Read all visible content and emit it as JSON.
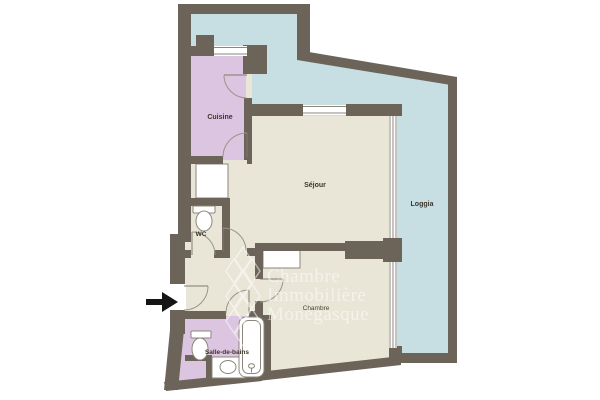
{
  "plan": {
    "rooms": {
      "cuisine": {
        "label": "Cuisine",
        "fill": "#dcc5e0"
      },
      "sejour": {
        "label": "Séjour",
        "fill": "#e9e6d7"
      },
      "loggia": {
        "label": "Loggia",
        "fill": "#c7dee2"
      },
      "wc": {
        "label": "WC",
        "fill": "#e9e6d7"
      },
      "chambre": {
        "label": "Chambre",
        "fill": "#e9e6d7"
      },
      "salle_de_bains": {
        "label": "Salle-de-bains",
        "fill": "#dcc5e0"
      }
    },
    "watermark": {
      "line1": "Chambre",
      "line2": "Immobilière",
      "line3": "Monégasque",
      "color": "#ffffff"
    },
    "colors": {
      "wall": "#6c6359",
      "floor_beige": "#e9e6d7",
      "kitchen_bath_purple": "#dcc5e0",
      "terrace_blue": "#c7dee2",
      "fixture_line": "#8d867b",
      "label_text": "#3a362d",
      "entrance_arrow": "#151515"
    },
    "entrance": {
      "direction": "right"
    }
  }
}
